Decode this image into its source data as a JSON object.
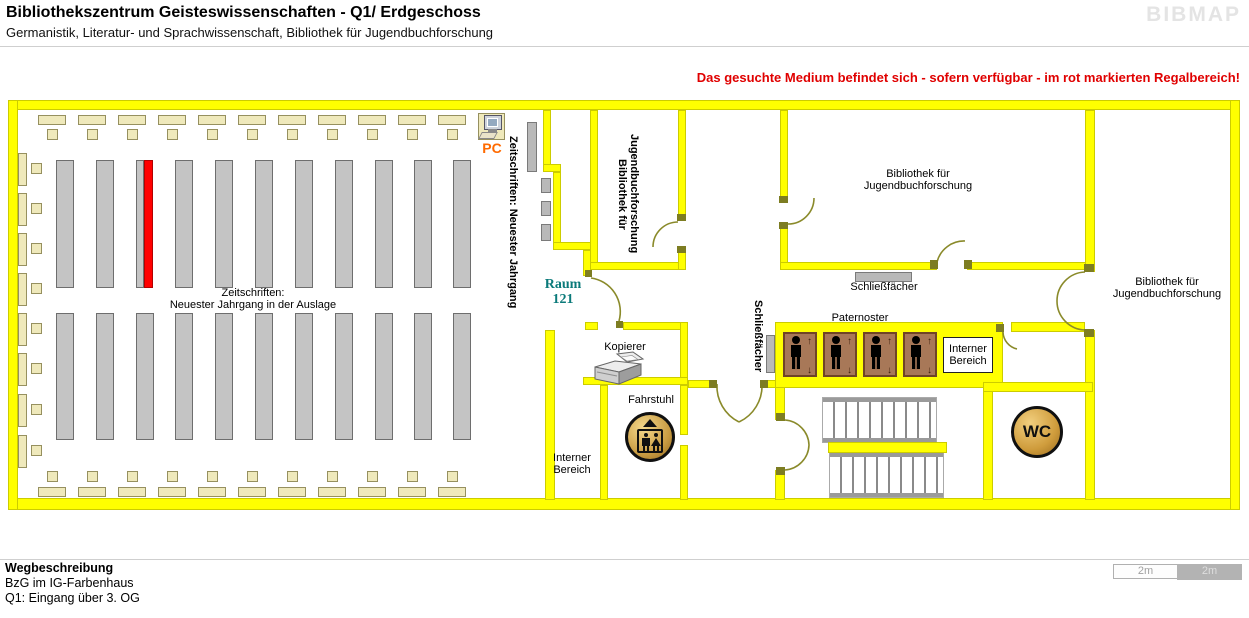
{
  "header": {
    "title": "Bibliothekszentrum Geisteswissenschaften - Q1/ Erdgeschoss",
    "subtitle": "Germanistik, Literatur- und Sprachwissenschaft, Bibliothek für Jugendbuchforschung",
    "logo": "BIBMAP"
  },
  "notice": "Das gesuchte Medium befindet sich - sofern verfügbar -  im rot markierten Regalbereich!",
  "labels": {
    "pc": "PC",
    "zeitschriften_wall": "Zeitschriften: Neuester Jahrgang",
    "auslage": [
      "Zeitschriften:",
      "Neuester Jahrgang in der Auslage"
    ],
    "raum": [
      "Raum",
      "121"
    ],
    "bibliothek": [
      "Bibliothek für",
      "Jugendbuchforschung"
    ],
    "schliessfaecher": "Schließfächer",
    "paternoster": "Paternoster",
    "interner_bereich": [
      "Interner",
      "Bereich"
    ],
    "kopierer": "Kopierer",
    "fahrstuhl": "Fahrstuhl",
    "wc": "WC"
  },
  "legend": {
    "heading": "Wegbeschreibung",
    "lines": [
      "BzG im IG-Farbenhaus",
      "Q1: Eingang über 3. OG"
    ]
  },
  "scale": {
    "left": "2m",
    "right": "2m"
  },
  "colors": {
    "wall": "#ffff00",
    "wall_border": "#cccc00",
    "shelf": "#c4c4c4",
    "furniture": "#efe9bb",
    "highlight": "#ff0000",
    "door": "#8a8a2a",
    "cabin": "#a87858",
    "cabin_border": "#6f4426",
    "notice_red": "#e00000",
    "raum_teal": "#0b7a7a",
    "pc_orange": "#ff6a00",
    "logo_gray": "#e4e4e4",
    "scale_gray": "#b3b3b3"
  },
  "structure": {
    "shelf_columns": 11,
    "red_shelf_column": 3,
    "paternoster_cabins": 4,
    "stair_flights": 2
  }
}
